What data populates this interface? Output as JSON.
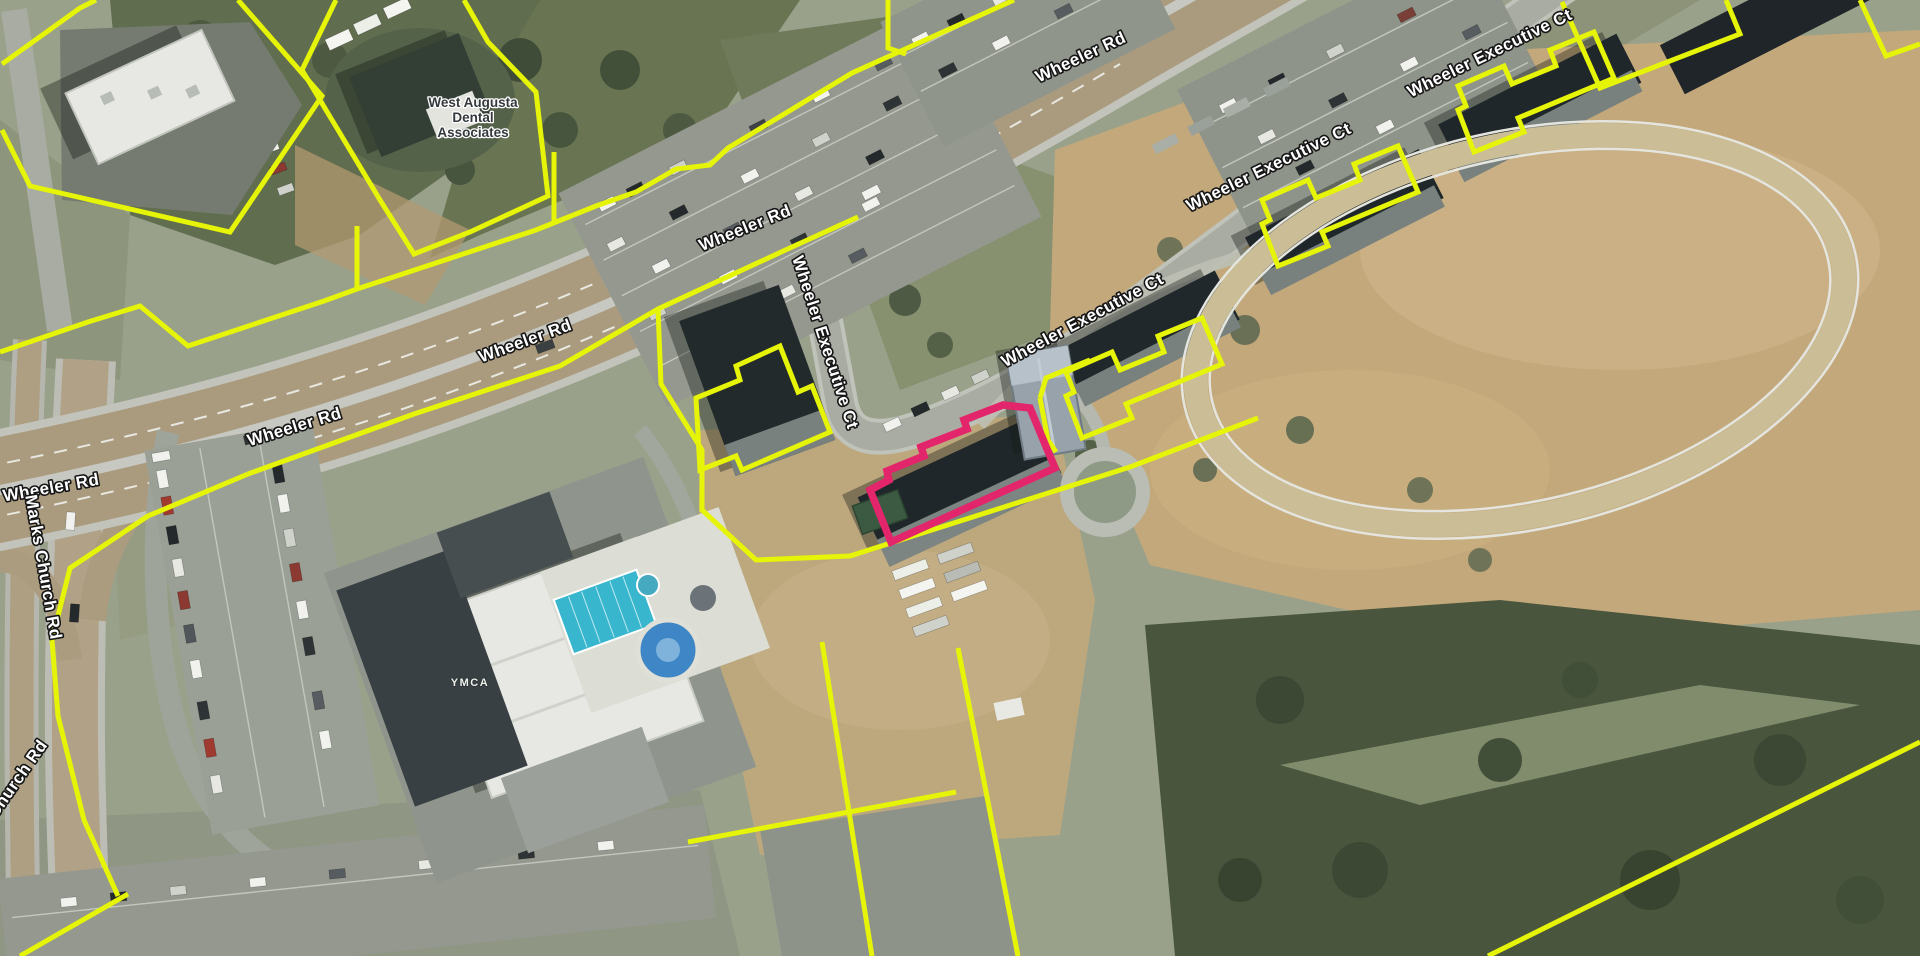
{
  "map": {
    "view": "aerial-parcel-map",
    "colors": {
      "parcel_outline": "#e6f407",
      "selected_parcel_outline": "#e3256b",
      "road_label_fill": "#ffffff",
      "road_label_halo": "#161616",
      "poi_label_fill": "#34393c",
      "poi_label_halo": "#ffffff"
    },
    "road_labels": [
      {
        "text": "Wheeler Rd",
        "x": 1083,
        "y": 62,
        "rot": -25
      },
      {
        "text": "Wheeler Rd",
        "x": 747,
        "y": 233,
        "rot": -22
      },
      {
        "text": "Wheeler Rd",
        "x": 527,
        "y": 346,
        "rot": -20
      },
      {
        "text": "Wheeler Rd",
        "x": 296,
        "y": 432,
        "rot": -17
      },
      {
        "text": "Wheeler Rd",
        "x": 52,
        "y": 493,
        "rot": -10
      },
      {
        "text": "Marks Church Rd",
        "x": 38,
        "y": 568,
        "rot": 80
      },
      {
        "text": "Church Rd",
        "x": 22,
        "y": 782,
        "rot": -55
      },
      {
        "text": "Wheeler Executive Ct",
        "x": 820,
        "y": 344,
        "rot": 72
      },
      {
        "text": "Wheeler Executive Ct",
        "x": 1085,
        "y": 325,
        "rot": -28
      },
      {
        "text": "Wheeler Executive Ct",
        "x": 1271,
        "y": 172,
        "rot": -26
      },
      {
        "text": "Wheeler Executive Ct",
        "x": 1492,
        "y": 58,
        "rot": -26
      }
    ],
    "poi_labels": {
      "dental": {
        "lines": [
          "West Augusta",
          "Dental",
          "Associates"
        ],
        "x": 473,
        "y": 107
      },
      "ymca": {
        "text": "YMCA",
        "x": 470,
        "y": 686
      }
    }
  }
}
